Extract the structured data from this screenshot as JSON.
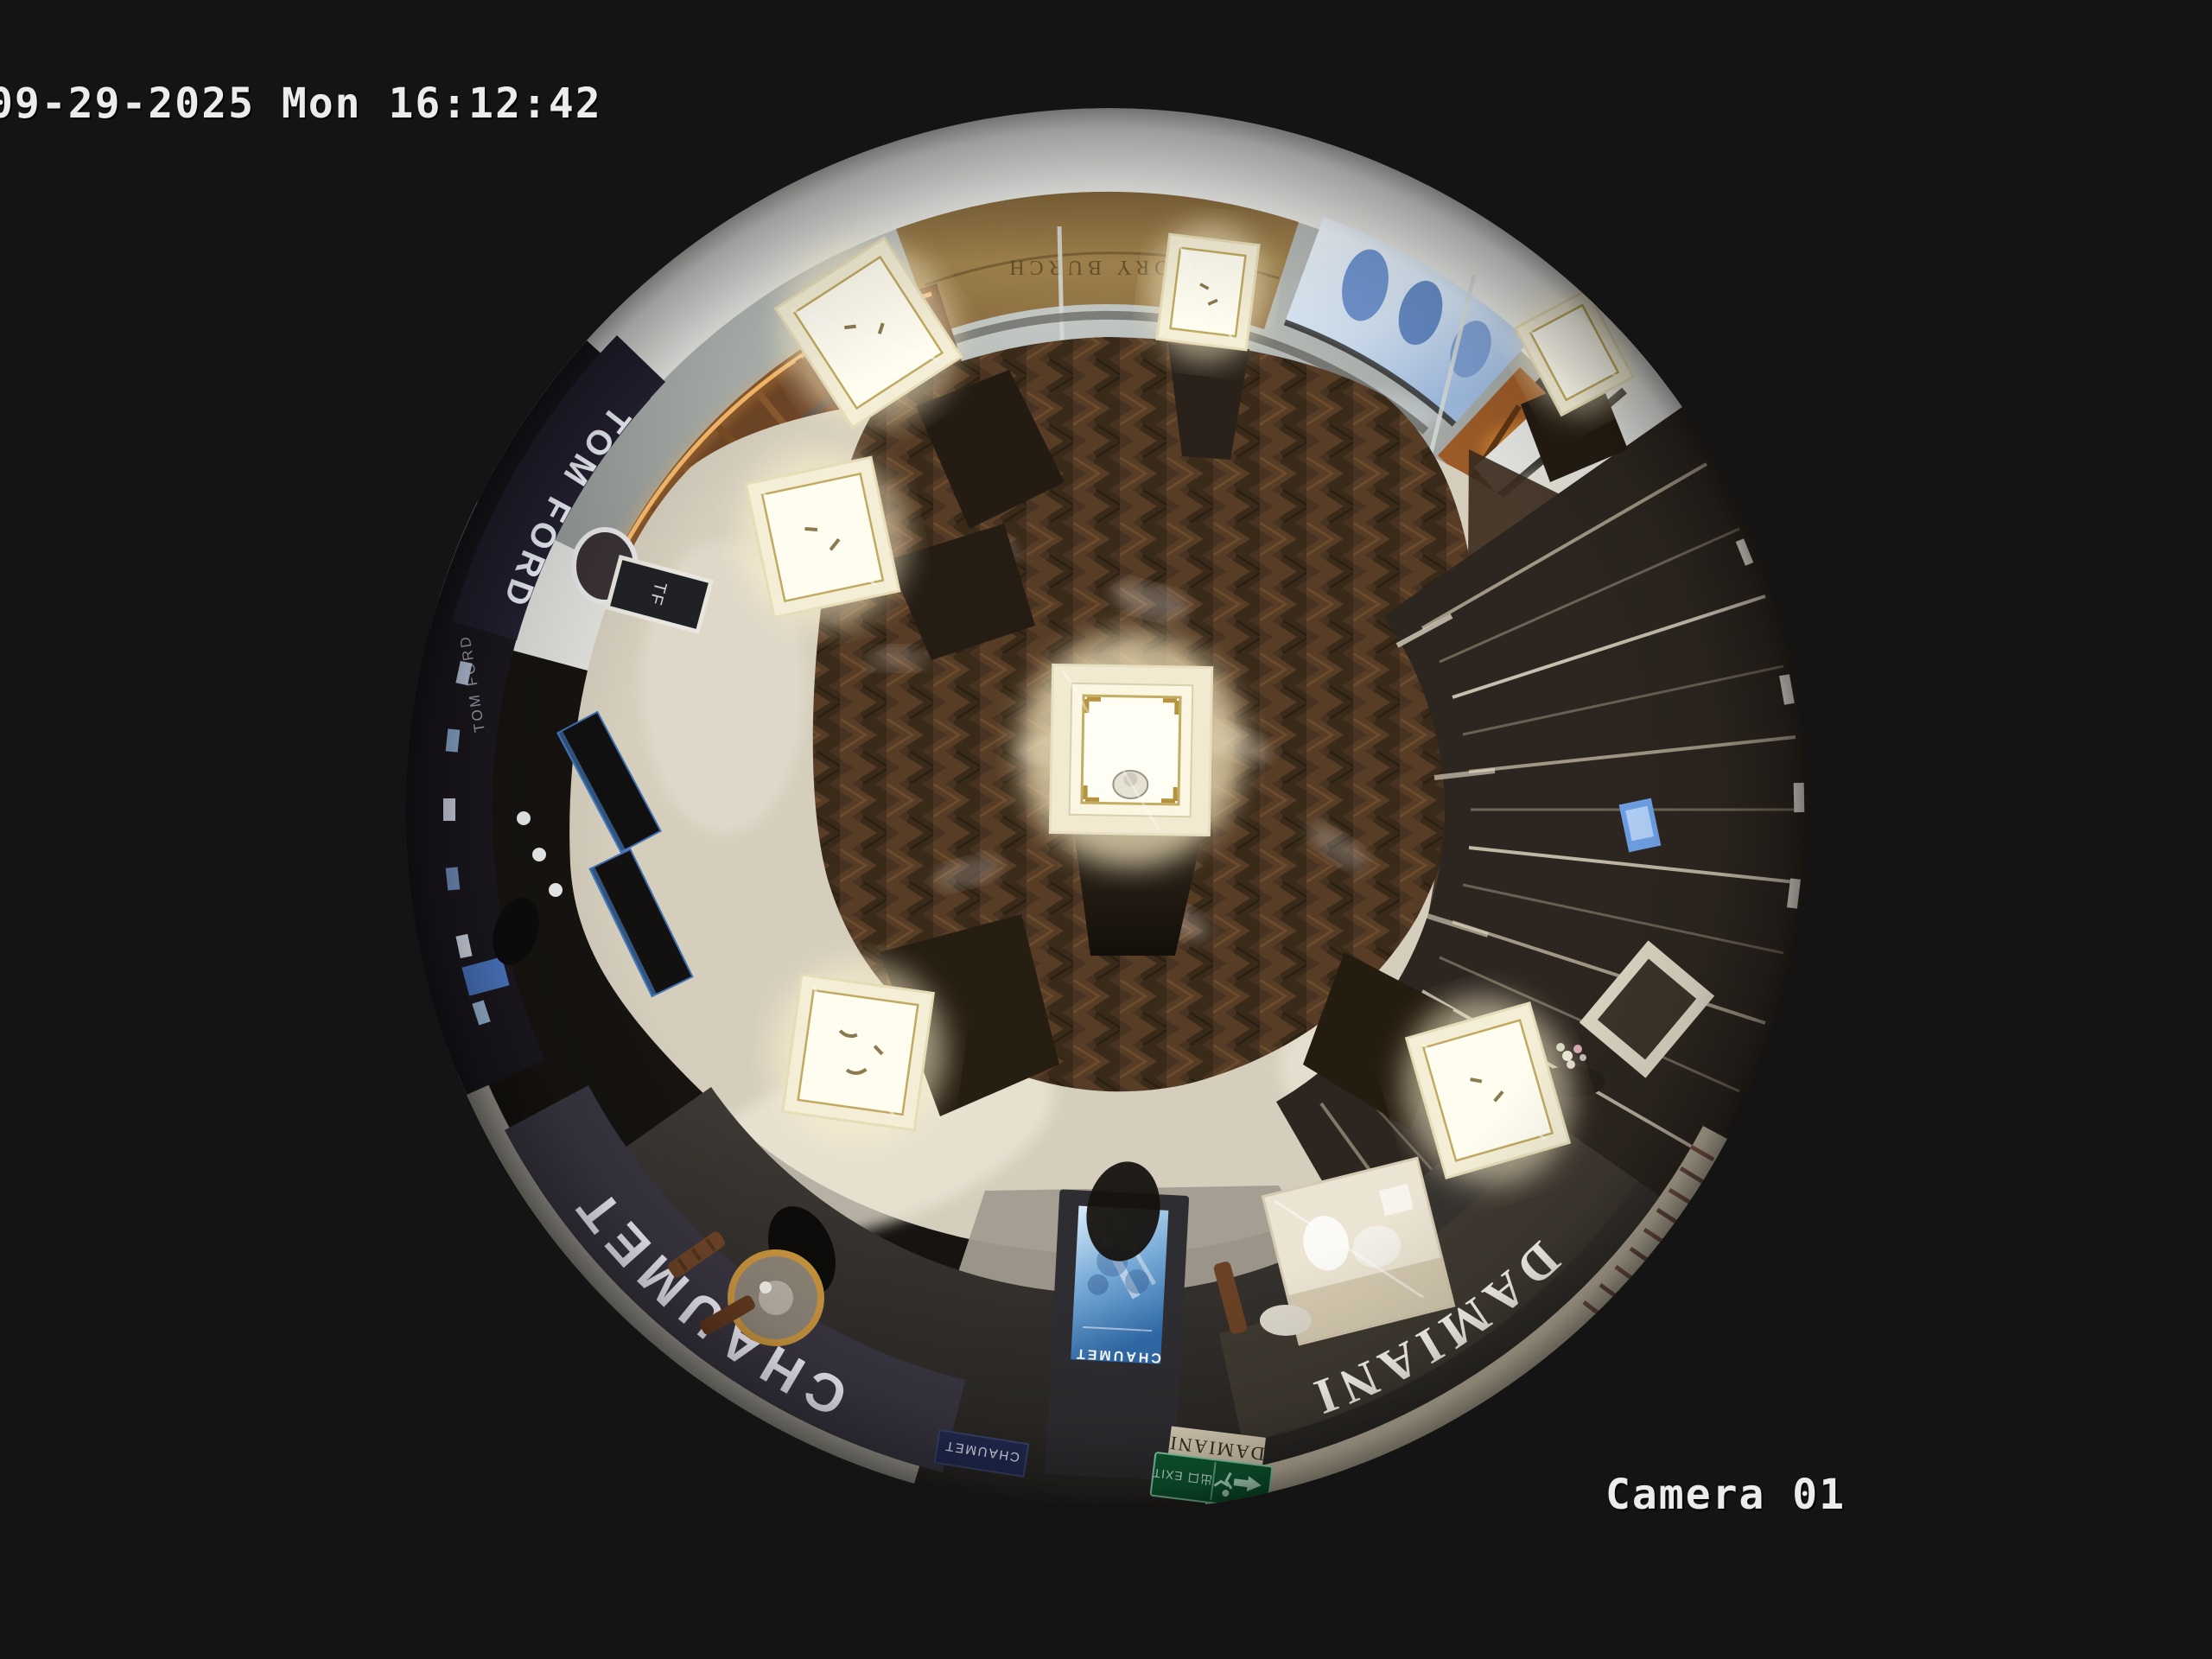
{
  "osd": {
    "timestamp": "09-29-2025 Mon 16:12:42",
    "camera_label": "Camera 01"
  },
  "boutique": {
    "signs": {
      "chaumet_fascia": "CHAUMET",
      "chaumet_screen_logo": "CHAUMET",
      "chaumet_entrance_panel": "CHAUMET",
      "damiani_fascia": "DAMIANI",
      "damiani_entrance_panel": "DAMIANI",
      "tom_ford_fascia": "TOM FORD",
      "tom_ford_secondary": "TOM FORD",
      "tf_monogram": "TF",
      "neighbor_storefront": "TORY BURCH",
      "exit_sign_text": "出口 EXIT"
    },
    "colors": {
      "background": "#141414",
      "osd_text": "#ececec",
      "exit_green": "#2ca05e",
      "kiosk_led_amber": "#ffb14d",
      "promo_screen_blue": "#4a7fc1",
      "case_glow_warm": "#fff6d8",
      "wood_floor_brown": "#4a3522"
    }
  }
}
